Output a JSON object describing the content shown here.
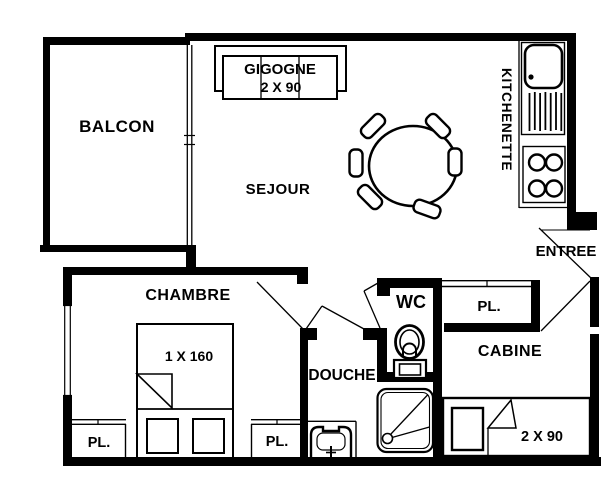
{
  "rooms": {
    "balcon": "BALCON",
    "sejour": "SEJOUR",
    "kitchenette": "KITCHENETTE",
    "entree": "ENTREE",
    "chambre": "CHAMBRE",
    "wc": "WC",
    "douche": "DOUCHE",
    "cabine": "CABINE"
  },
  "closets": {
    "hall": "PL.",
    "chambre_left": "PL.",
    "chambre_right": "PL."
  },
  "furniture": {
    "sofa_bed_name": "GIGOGNE",
    "sofa_bed_size": "2 X 90",
    "chambre_bed_size": "1 X 160",
    "cabine_bed_size": "2 X 90"
  },
  "colors": {
    "line": "#000000",
    "background": "#ffffff"
  }
}
